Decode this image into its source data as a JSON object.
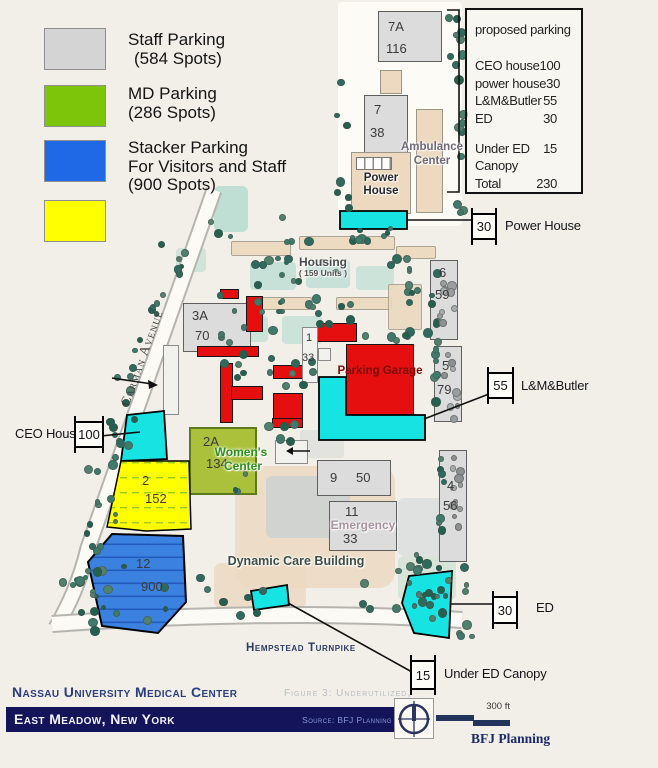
{
  "legend": {
    "items": [
      {
        "color": "#d4d4d4",
        "lines": [
          "Staff Parking",
          "(584 Spots)"
        ]
      },
      {
        "color": "#7cc50a",
        "lines": [
          "MD Parking",
          "(286 Spots)"
        ]
      },
      {
        "color": "#2069e6",
        "lines": [
          "Stacker Parking",
          "For Visitors and Staff",
          "(900 Spots)"
        ]
      },
      {
        "color": "#ffff00",
        "lines": []
      }
    ]
  },
  "proposed_parking": {
    "title": "proposed parking",
    "rows": [
      [
        "CEO house",
        "100"
      ],
      [
        "power house",
        "30"
      ],
      [
        "L&M&Butler",
        "55"
      ],
      [
        "ED",
        "30"
      ],
      [
        "Under ED",
        "15"
      ],
      [
        "Canopy",
        ""
      ],
      [
        "Total",
        "230"
      ]
    ]
  },
  "buildings": {
    "b7a": {
      "name": "7A",
      "value": "116"
    },
    "b7": {
      "name": "7",
      "value": "38"
    },
    "b3a": {
      "name": "3A",
      "value": "70"
    },
    "b6": {
      "name": "6",
      "value": "59"
    },
    "b5": {
      "name": "5",
      "value": "79"
    },
    "b4": {
      "name": "4",
      "value": "56"
    },
    "b1": {
      "name": "1",
      "value": "33"
    },
    "b9": {
      "name": "9",
      "value": "50"
    },
    "b11": {
      "name": "11",
      "value": "33",
      "label": "Emergency"
    },
    "b2a": {
      "name": "2A",
      "value": "134",
      "label_line1": "Women's",
      "label_line2": "Center"
    },
    "garage": {
      "label": "Parking Garage"
    },
    "power_house": {
      "label_line1": "Power",
      "label_line2": "House"
    },
    "ambulance": {
      "label_line1": "Ambulance",
      "label_line2": "Center"
    }
  },
  "lots": {
    "yellow": {
      "name": "2",
      "value": "152"
    },
    "blue": {
      "name": "12",
      "value": "900"
    }
  },
  "map_labels": {
    "housing": "Housing",
    "housing_units": "( 159 Units )",
    "carman": "Carman Avenue",
    "hempstead": "Hempstead Turnpike",
    "dynamic_care": "Dynamic Care Building"
  },
  "callouts": {
    "power_house": {
      "value": "30",
      "label": "Power House"
    },
    "lmb": {
      "value": "55",
      "label": "L&M&Butler"
    },
    "ceo": {
      "value": "100",
      "label": "CEO House"
    },
    "ed": {
      "value": "30",
      "label": "ED"
    },
    "under_ed": {
      "value": "15",
      "label": "Under ED Canopy"
    }
  },
  "footer": {
    "title": "Nassau University Medical Center",
    "subtitle": "East Meadow, New York",
    "source": "Source: BFJ Planning",
    "figure_caption": "Figure 3: Underutilized,",
    "brand": "BFJ Planning",
    "scale": "300 ft"
  }
}
